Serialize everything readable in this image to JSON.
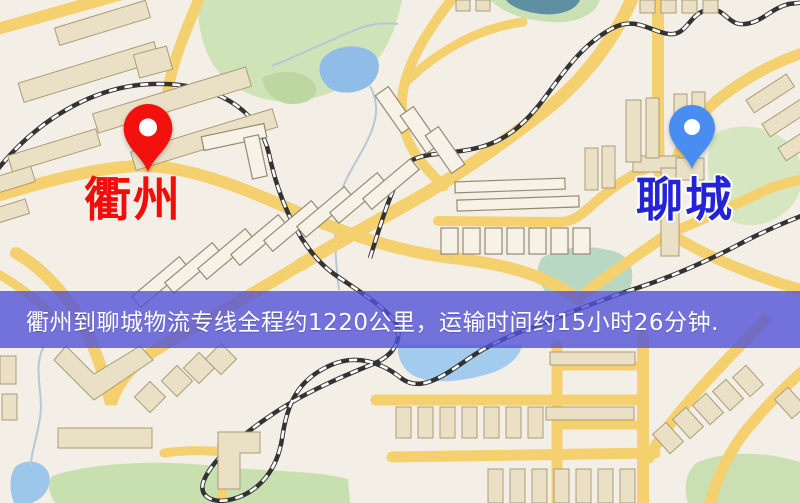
{
  "map": {
    "origin": {
      "name": "衢州",
      "pin_color": "#f2110d",
      "label_color": "#f20c0c"
    },
    "destination": {
      "name": "聊城",
      "pin_color": "#4a8df0",
      "label_color": "#2424d6"
    },
    "banner": {
      "text": "衢州到聊城物流专线全程约1220公里，运输时间约15小时26分钟.",
      "background_color": "#5252d8",
      "text_color": "#ffffff"
    },
    "route_facts": {
      "distance": "约1220公里",
      "duration": "约15小时26分钟"
    },
    "colors": {
      "map_background": "#f3efe7",
      "road": "#f5d06e",
      "park": "#cfe3b8",
      "water": "#9cc6ea",
      "railway": "#333333",
      "building": "#e9e0c5"
    }
  }
}
